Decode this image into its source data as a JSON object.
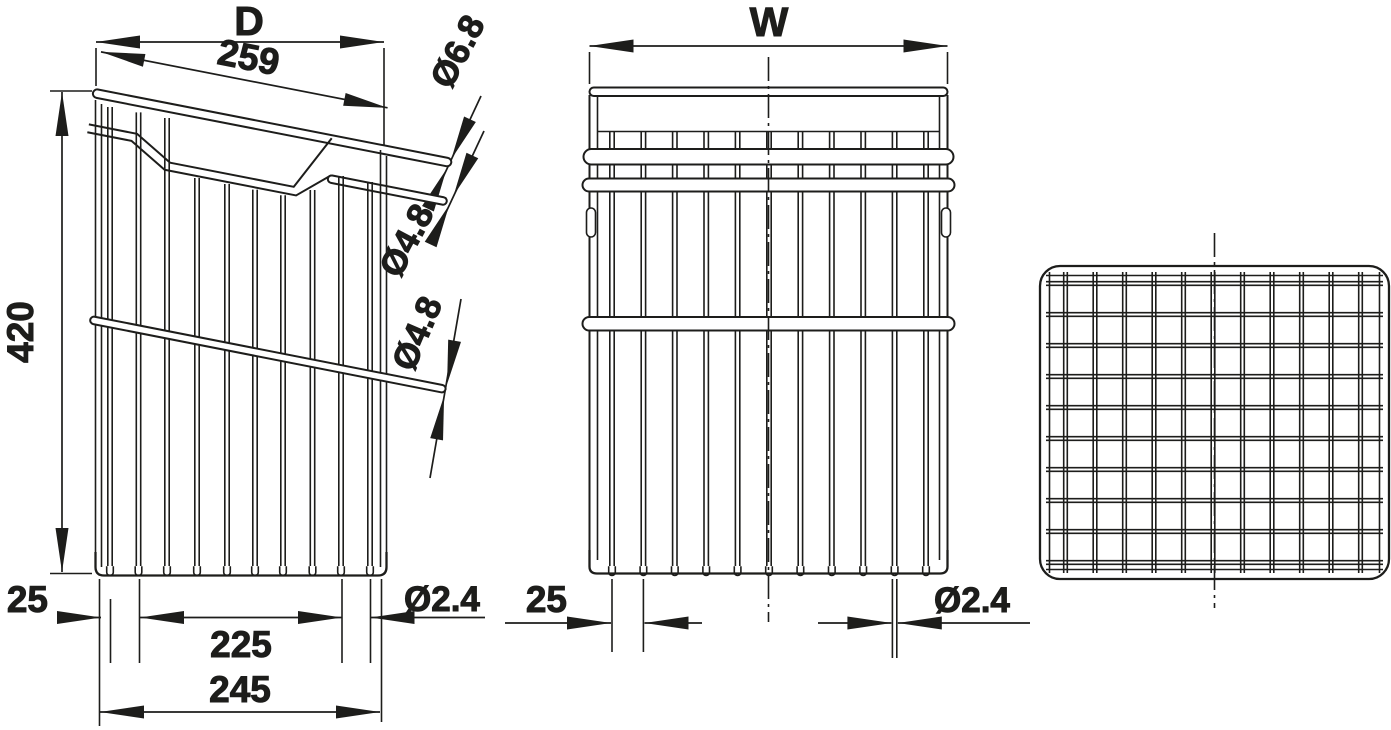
{
  "drawing_title": "wire-basket-three-view-technical-drawing",
  "colors": {
    "line": "#1d1d1b",
    "background": "#ffffff"
  },
  "side_view": {
    "label_depth": "D",
    "dim_top_length": "259",
    "dim_height": "420",
    "dim_wire_offset": "25",
    "dim_inner_width": "225",
    "dim_outer_width": "245",
    "dia_top_rail": "Ø6.8",
    "dia_upper_rail": "Ø4.8",
    "dia_middle_rail": "Ø4.8",
    "dia_wire": "Ø2.4"
  },
  "front_view": {
    "label_width": "W",
    "dim_wire_spacing": "25",
    "dia_wire": "Ø2.4"
  },
  "top_view": {}
}
